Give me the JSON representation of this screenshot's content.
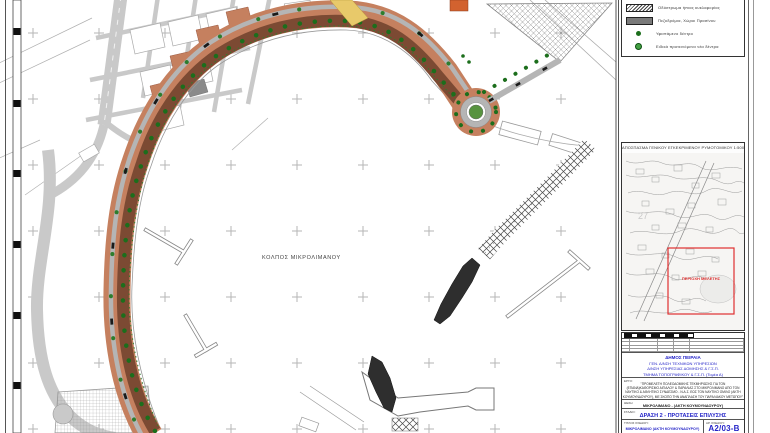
{
  "map": {
    "sea_label": "ΚΟΛΠΟΣ ΜΙΚΡΟΛΙΜΑΝΟΥ"
  },
  "legend": {
    "items": [
      {
        "swatch": "hatch-bar",
        "label": "Οδόστρωμα ήπιας κυκλοφορίας"
      },
      {
        "swatch": "gray-bar",
        "label": "Πεζοδρόμια, Χώροι Πρασίνου"
      },
      {
        "swatch": "green-dot",
        "label": "Υφιστάμενο δέντρο"
      },
      {
        "swatch": "ringed-green-dot",
        "label": "Ειδικά προτεινόμενα νέα δέντρα"
      }
    ]
  },
  "location_map": {
    "title": "ΑΠΟΣΠΑΣΜΑ ΓΕΝΙΚΟΥ ΕΓΚΕΚΡΙΜΕΝΟΥ ΡΥΜΟΤΟΜΙΚΟΥ 1:5000",
    "study_area_label": "ΠΕΡΙΟΧΗ ΜΕΛΕΤΗΣ",
    "background_number": "27"
  },
  "title_block": {
    "captions": {
      "project": "ΕΡΓΟ:",
      "location": "ΘΕΣΗ:",
      "stage": "ΣΤΑΔΙΟ:",
      "sheet_title": "ΤΙΤΛΟΣ ΣΧΕΔΙΟΥ:",
      "number": "ΑΡ. ΣΧΕΔΙΟΥ:"
    },
    "authority_lines": [
      "ΔΗΜΟΣ ΠΕΙΡΑΙΑ",
      "ΓΕΝ. Δ/ΝΣΗ ΤΕΧΝΙΚΩΝ ΥΠΗΡΕΣΙΩΝ",
      "Δ/ΝΣΗ ΥΠΗΡΕΣΙΑΣ ΔΟΜΗΣΗΣ & Γ.Σ.Π.",
      "ΤΜΗΜΑ ΤΟΠΟΓΡΑΦΙΚΟΥ & Γ.Σ.Π. (Τομέα Α)"
    ],
    "project_lines": [
      "\"ΠΡΟΜΕΛΕΤΗ ΠΟΛΕΟΔΟΜΙΚΗΣ ΤΕΚΜΗΡΙΩΣΗΣ ΓΙΑ ΤΟΝ",
      "(ΕΠΑΝΑ)ΚΑΘΟΡΙΣΜΟ ΑΙΓΙΑΛΟΥ & ΠΑΡΑΛΙΑΣ ΣΤΟ ΜΙΚΡΟΛΙΜΑΝΟ ΑΠΟ ΤΟΝ",
      "ΝΑΥΤΙΚΟ & ΑΘΛΗΤΙΚΟ ΣΥΝΔΕΣΜΟ - Ν.Α.Σ. ΕΩΣ ΤΟΝ ΝΑΥΤΙΚΟ ΟΜΙΛΟ (ΑΚΤΗ",
      "ΚΟΥΜΟΥΝΔΟΥΡΟΥ), ΜΕ ΣΚΟΠΟ ΤΗΝ ΑΝΑΠΛΑΣΗ ΤΟΥ ΠΑΡΑΛΙΑΚΟΥ ΜΕΤΩΠΟΥ\""
    ],
    "location": "ΜΙΚΡΟΛΙΜΑΝΟ - (ΑΚΤΗ ΚΟΥΜΟΥΝΔΟΥΡΟΥ)",
    "action": "ΔΡΑΣΗ 2 - ΠΡΟΤΑΣΕΙΣ ΕΠΙΛΥΣΗΣ",
    "sheet_name": "ΜΙΚΡΟΛΙΜΑΝΟ (ΑΚΤΗ ΚΟΥΜΟΥΝΔΟΥΡΟΥ)",
    "drawing_number": "Α2/03-Β"
  },
  "colors": {
    "promenade_outer": "#c5805f",
    "promenade_inner": "#7c4a33",
    "tree_green": "#1c6e1c",
    "road_gray": "#c9c9c9",
    "accent_blue": "#2525c8",
    "study_area_red": "#e03030"
  }
}
